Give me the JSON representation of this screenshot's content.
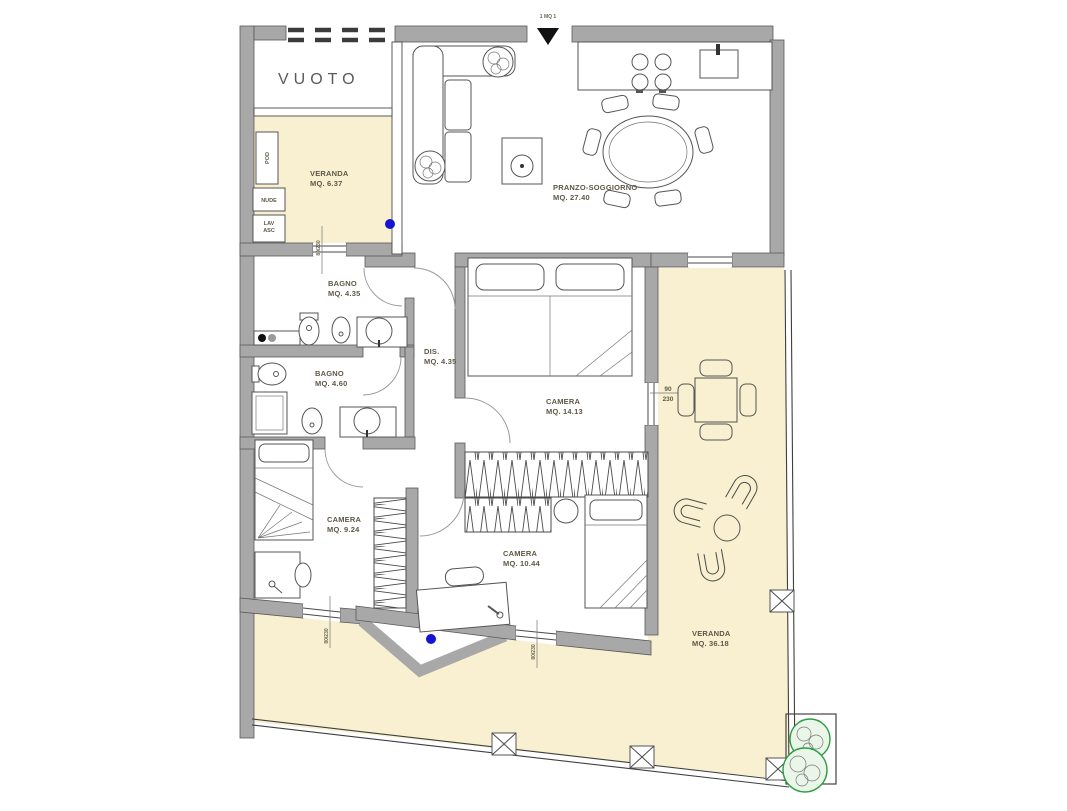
{
  "plan": {
    "entrance_marker": "1 MQ 1",
    "rooms": {
      "vuoto": {
        "name": "VUOTO",
        "area": ""
      },
      "veranda_small": {
        "name": "VERANDA",
        "area": "MQ. 6.37"
      },
      "soggiorno": {
        "name": "PRANZO-SOGGIORNO",
        "area": "MQ. 27.40"
      },
      "bagno1": {
        "name": "BAGNO",
        "area": "MQ. 4.35"
      },
      "bagno2": {
        "name": "BAGNO",
        "area": "MQ. 4.60"
      },
      "dis": {
        "name": "DIS.",
        "area": "MQ. 4.35"
      },
      "camera_matrimoniale": {
        "name": "CAMERA",
        "area": "MQ. 14.13"
      },
      "camera_piccola": {
        "name": "CAMERA",
        "area": "MQ. 9.24"
      },
      "camera_media": {
        "name": "CAMERA",
        "area": "MQ. 10.44"
      },
      "veranda_large": {
        "name": "VERANDA",
        "area": "MQ. 36.18"
      }
    },
    "appliance_labels": {
      "pod": "POD",
      "nude": "NUDE",
      "lav": "LAV",
      "asc": "ASC"
    },
    "dimensions": {
      "balcony_door_width": "90",
      "balcony_door_height": "230",
      "window_dim": "80/230"
    },
    "colors": {
      "wall_gray": "#a8a8a8",
      "wall_edge": "#595959",
      "veranda_cream": "#f8f0d0",
      "marker_blue": "#1414d2",
      "plant_green": "#2e9e44",
      "label_text": "#5f5847"
    }
  }
}
